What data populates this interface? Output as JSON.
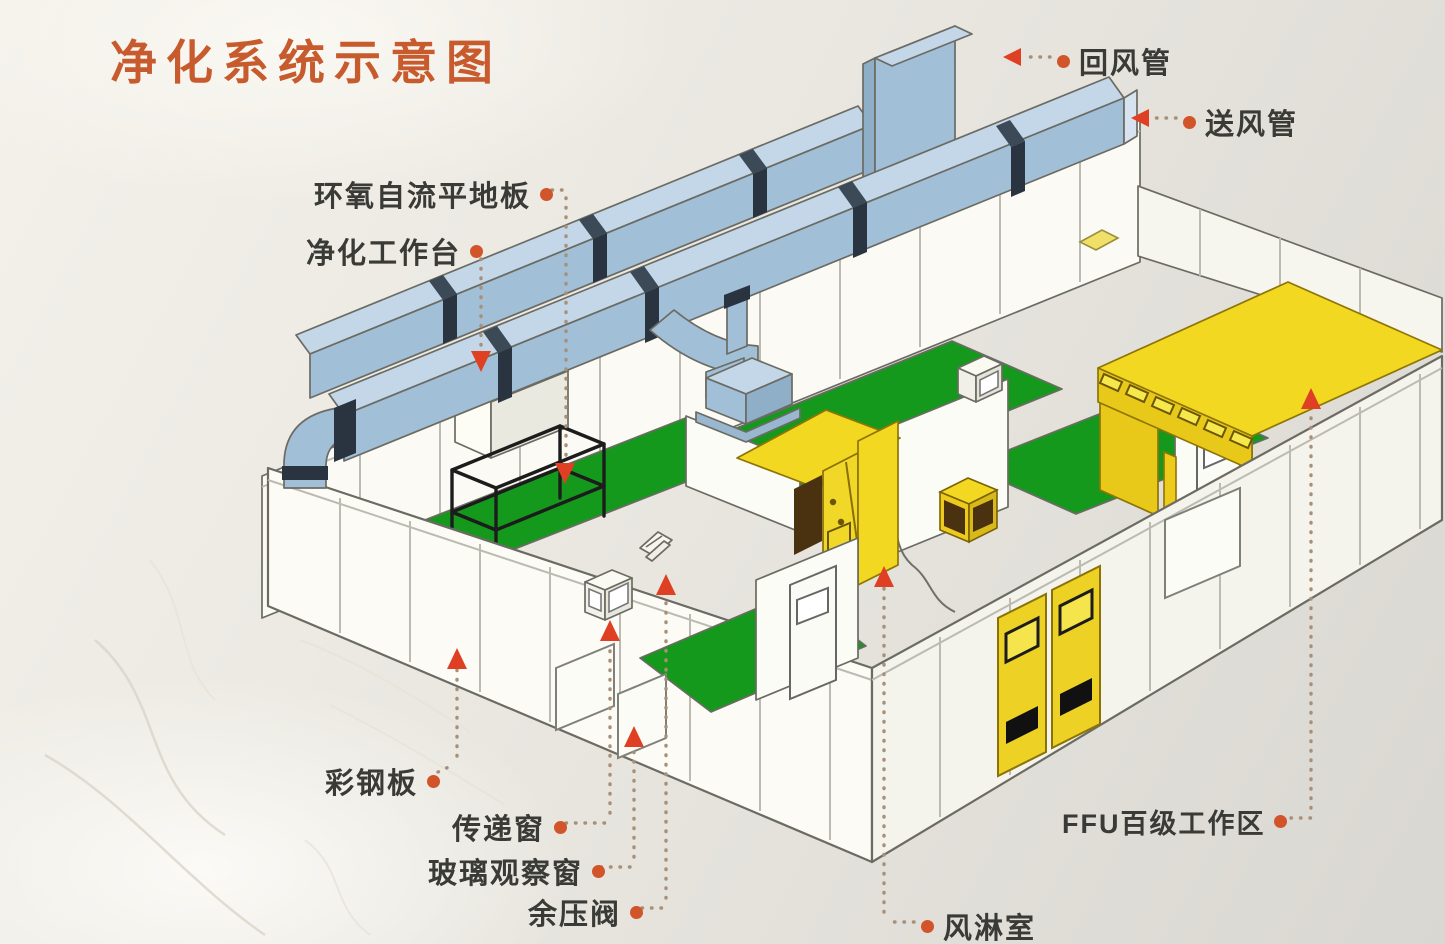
{
  "title": {
    "text": "净化系统示意图"
  },
  "colors": {
    "title": "#c75b2e",
    "label_text": "#3a3a36",
    "leader": "#a89078",
    "dot": "#d2542a",
    "pointer": "#df4023",
    "duct_top": "#c3d7e8",
    "duct_side": "#a2bfd8",
    "duct_dark": "#8fafc9",
    "flange": "#2a3440",
    "floor_green": "#14991d",
    "yellow": "#f2d821",
    "yellow_deep": "#e8c91a",
    "brown": "#4a3110",
    "wall": "#fbfaf4",
    "outline": "#6b6b63"
  },
  "annotations": [
    {
      "id": "return-air-duct",
      "text": "回风管",
      "dot_side": "left",
      "arrow": "left"
    },
    {
      "id": "supply-air-duct",
      "text": "送风管",
      "dot_side": "left",
      "arrow": "left"
    },
    {
      "id": "epoxy-self-leveling-floor",
      "text": "环氧自流平地板",
      "dot_side": "right",
      "arrow": "down"
    },
    {
      "id": "clean-workbench",
      "text": "净化工作台",
      "dot_side": "right",
      "arrow": "down"
    },
    {
      "id": "color-steel-panel",
      "text": "彩钢板",
      "dot_side": "right",
      "arrow": "up"
    },
    {
      "id": "transfer-window",
      "text": "传递窗",
      "dot_side": "right",
      "arrow": "up"
    },
    {
      "id": "glass-observation-window",
      "text": "玻璃观察窗",
      "dot_side": "right",
      "arrow": "up"
    },
    {
      "id": "residual-pressure-valve",
      "text": "余压阀",
      "dot_side": "right",
      "arrow": "up"
    },
    {
      "id": "air-shower-room",
      "text": "风淋室",
      "dot_side": "left",
      "arrow": "up"
    },
    {
      "id": "ffu-class100-work-area",
      "text": "FFU百级工作区",
      "dot_side": "right",
      "arrow": "up"
    }
  ]
}
